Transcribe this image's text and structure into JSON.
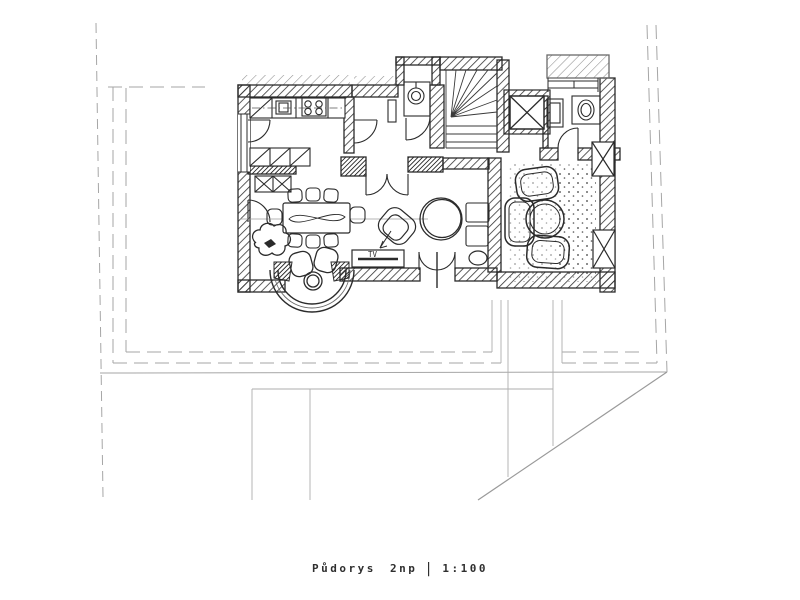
{
  "page": {
    "background": "#ffffff"
  },
  "caption": {
    "title": "Půdorys 2np",
    "separator": "|",
    "scale": "1:100"
  },
  "plan": {
    "kind": "hand-drawn architectural floor plan sketch over light CAD site lines",
    "colors": {
      "paper": "#ffffff",
      "ink": "#2b2b2b",
      "pencil": "#8a8a8a",
      "cad_line": "#a6a6a6"
    },
    "labels": {
      "tv_stand": "TV"
    },
    "rooms": [
      "kitchen",
      "hall",
      "staircase",
      "boiler-closet",
      "shaft",
      "bathroom",
      "dining-area",
      "living-area",
      "lounge",
      "bay-window"
    ],
    "furniture": [
      "kitchen-counter",
      "corner-cabinet",
      "sink",
      "stove",
      "wardrobe-cabinets",
      "dining-table",
      "dining-chairs",
      "plant",
      "bay-chairs",
      "bay-table",
      "tv-stand",
      "armchair",
      "round-rug",
      "shelf-unit",
      "pouf",
      "lounge-chairs",
      "sofa",
      "coffee-table",
      "washbasin",
      "toilet",
      "boiler",
      "radiator"
    ]
  }
}
